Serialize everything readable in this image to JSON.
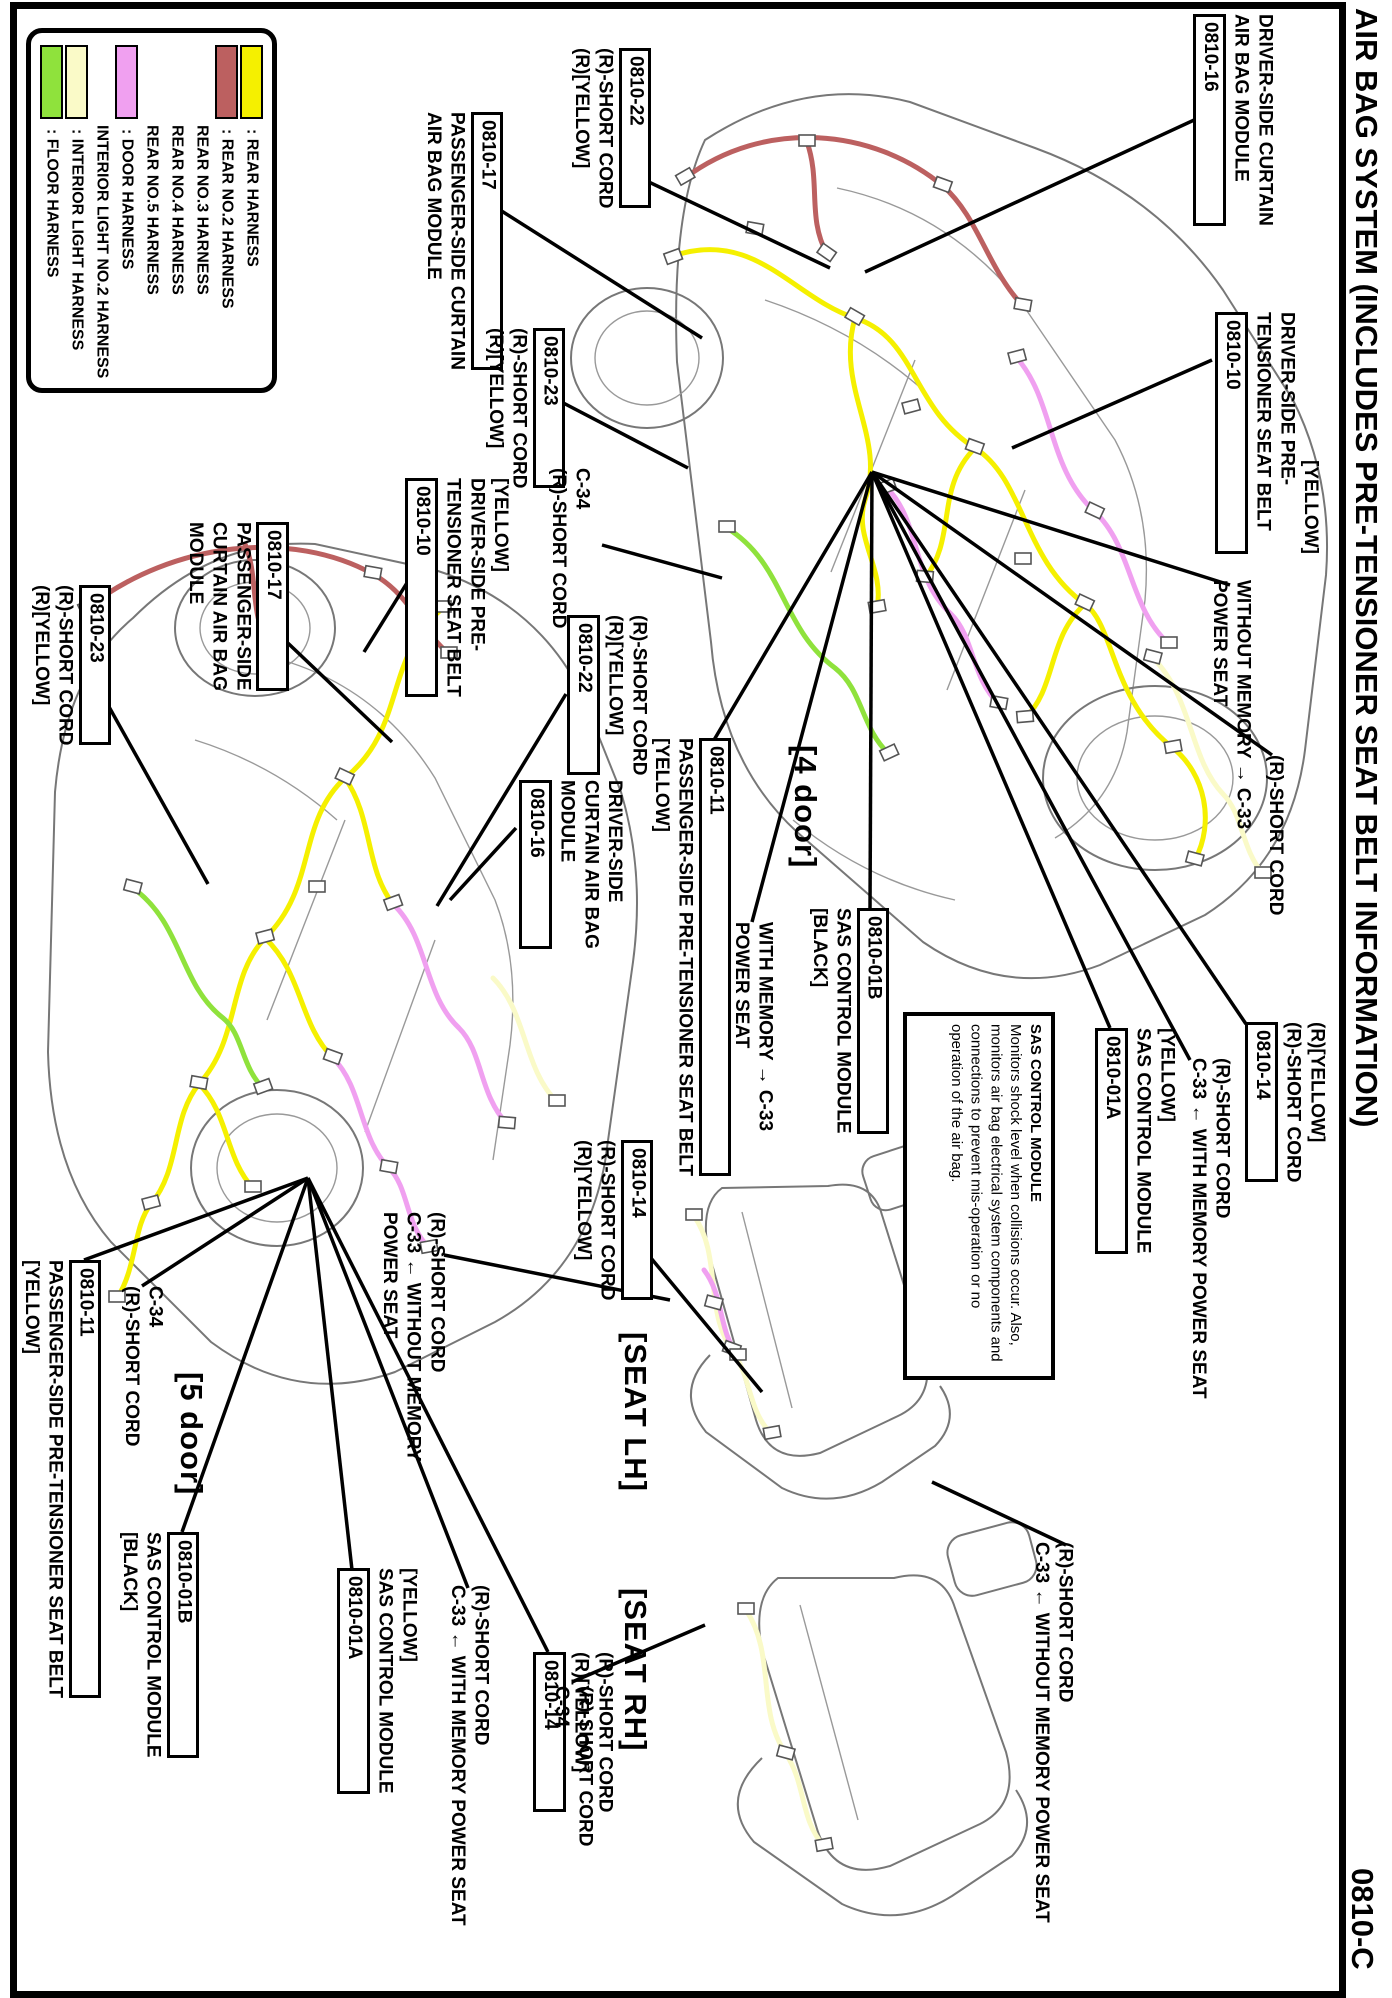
{
  "page": {
    "title": "AIR BAG SYSTEM (INCLUDES PRE-TENSIONER SEAT BELT INFORMATION)",
    "page_code": "0810-C"
  },
  "colors": {
    "floor": "#8FE23C",
    "int": "#FAFAC8",
    "door": "#F0A0F0",
    "rear2": "#BC6060",
    "rear": "#F5F000",
    "outline": "#777",
    "leader": "#000"
  },
  "legend": {
    "items": [
      {
        "label": ": FLOOR HARNESS",
        "color": "#8FE23C"
      },
      {
        "label": ": INTERIOR LIGHT HARNESS",
        "color": "#FAFAC8"
      },
      {
        "label": "INTERIOR LIGHT NO.2 HARNESS",
        "color": null
      },
      {
        "label": ": DOOR HARNESS",
        "color": "#F0A0F0"
      },
      {
        "label": "REAR NO.5 HARNESS",
        "color": null
      },
      {
        "label": "REAR NO.4 HARNESS",
        "color": null
      },
      {
        "label": "REAR NO.3 HARNESS",
        "color": null
      },
      {
        "label": ": REAR NO.2 HARNESS",
        "color": "#BC6060"
      },
      {
        "label": ": REAR HARNESS",
        "color": "#F5F000"
      }
    ]
  },
  "note": {
    "heading": "SAS CONTROL MODULE",
    "body": "Monitors shock level when collisions occur. Also, monitors air bag electrical system components and connections to prevent mis-operation or no operation of the air bag."
  },
  "callouts": [
    {
      "id": "curtain-module-driver-4door",
      "x": 1190,
      "y": 14,
      "parts": [
        {
          "t": "DRIVER-SIDE CURTAIN"
        },
        {
          "t": "AIR BAG MODULE"
        },
        {
          "t": "0810-16",
          "box": true
        }
      ]
    },
    {
      "id": "short-cord-0810-22-4door",
      "x": 568,
      "y": 48,
      "parts": [
        {
          "t": "0810-22",
          "box": true
        },
        {
          "t": "(R)-SHORT CORD"
        },
        {
          "t": "(R)[YELLOW]"
        }
      ]
    },
    {
      "id": "curtain-module-passenger-4door",
      "x": 420,
      "y": 112,
      "parts": [
        {
          "t": "0810-17",
          "box": true
        },
        {
          "t": "PASSENGER-SIDE CURTAIN"
        },
        {
          "t": "AIR BAG MODULE"
        }
      ]
    },
    {
      "id": "short-cord-0810-23-4door",
      "x": 482,
      "y": 328,
      "parts": [
        {
          "t": "0810-23",
          "box": true
        },
        {
          "t": "(R)-SHORT CORD"
        },
        {
          "t": "(R)[YELLOW]"
        }
      ]
    },
    {
      "id": "c34-4door",
      "x": 545,
      "y": 468,
      "parts": [
        {
          "t": "C-34"
        },
        {
          "t": "(R)-SHORT CORD"
        }
      ]
    },
    {
      "id": "pretensioner-driver-4door",
      "x": 1212,
      "y": 312,
      "parts": [
        {
          "t": "[YELLOW]",
          "pad": 148
        },
        {
          "t": "DRIVER-SIDE PRE-"
        },
        {
          "t": "TENSIONER SEAT BELT"
        },
        {
          "t": "0810-10",
          "box": true
        }
      ]
    },
    {
      "id": "without-memory-4door",
      "x": 1206,
      "y": 580,
      "parts": [
        {
          "t": "WITHOUT MEMORY → C-33"
        },
        {
          "t": "POWER SEAT"
        }
      ]
    },
    {
      "id": "short-cord-4door",
      "x": 1262,
      "y": 755,
      "parts": [
        {
          "t": "(R)-SHORT CORD"
        }
      ]
    },
    {
      "id": "short-cord-0810-14-4door",
      "x": 1242,
      "y": 1022,
      "parts": [
        {
          "t": "(R)[YELLOW]"
        },
        {
          "t": "(R)-SHORT CORD"
        },
        {
          "t": "0810-14",
          "box": true
        }
      ]
    },
    {
      "id": "with-memory-c33-4door",
      "x": 1185,
      "y": 1058,
      "parts": [
        {
          "t": "(R)-SHORT CORD"
        },
        {
          "t": "C-33 ← WITH MEMORY POWER SEAT"
        }
      ]
    },
    {
      "id": "sas-0810-01a-4door",
      "x": 1092,
      "y": 1028,
      "parts": [
        {
          "t": "[YELLOW]"
        },
        {
          "t": "SAS CONTROL MODULE"
        },
        {
          "t": "0810-01A",
          "box": true
        }
      ]
    },
    {
      "id": "sas-0810-01b-4door",
      "x": 806,
      "y": 908,
      "parts": [
        {
          "t": "0810-01B",
          "box": true
        },
        {
          "t": "SAS CONTROL MODULE"
        },
        {
          "t": "[BLACK]"
        }
      ]
    },
    {
      "id": "with-memory-4door",
      "x": 728,
      "y": 922,
      "parts": [
        {
          "t": "WITH MEMORY → C-33"
        },
        {
          "t": "POWER SEAT"
        }
      ]
    },
    {
      "id": "section-4door",
      "x": 786,
      "y": 745,
      "big": true,
      "parts": [
        {
          "t": "[4 door]"
        }
      ]
    },
    {
      "id": "pretensioner-passenger-4door",
      "x": 648,
      "y": 738,
      "parts": [
        {
          "t": "0810-11",
          "box": true
        },
        {
          "t": "PASSENGER-SIDE PRE-TENSIONER SEAT BELT"
        },
        {
          "t": "[YELLOW]"
        }
      ]
    },
    {
      "id": "curtain-module-driver-5door",
      "x": 516,
      "y": 780,
      "parts": [
        {
          "t": "DRIVER-SIDE"
        },
        {
          "t": "CURTAIN AIR BAG"
        },
        {
          "t": "MODULE"
        },
        {
          "t": "0810-16",
          "box": true
        }
      ]
    },
    {
      "id": "short-cord-0810-22-5door",
      "x": 564,
      "y": 615,
      "parts": [
        {
          "t": "(R)-SHORT CORD"
        },
        {
          "t": "(R)[YELLOW]"
        },
        {
          "t": "0810-22",
          "box": true
        }
      ]
    },
    {
      "id": "pretensioner-driver-5door",
      "x": 402,
      "y": 478,
      "parts": [
        {
          "t": "[YELLOW]"
        },
        {
          "t": "DRIVER-SIDE PRE-"
        },
        {
          "t": "TENSIONER SEAT BELT"
        },
        {
          "t": "0810-10",
          "box": true
        }
      ]
    },
    {
      "id": "curtain-module-passenger-5door",
      "x": 182,
      "y": 522,
      "parts": [
        {
          "t": "0810-17",
          "box": true
        },
        {
          "t": "PASSENGER-SIDE"
        },
        {
          "t": "CURTAIN AIR BAG"
        },
        {
          "t": "MODULE"
        }
      ]
    },
    {
      "id": "short-cord-0810-23-5door",
      "x": 28,
      "y": 585,
      "parts": [
        {
          "t": "0810-23",
          "box": true
        },
        {
          "t": "(R)-SHORT CORD"
        },
        {
          "t": "(R)[YELLOW]"
        }
      ]
    },
    {
      "id": "pretensioner-passenger-5door",
      "x": 18,
      "y": 1260,
      "parts": [
        {
          "t": "0810-11",
          "box": true
        },
        {
          "t": "PASSENGER-SIDE PRE-TENSIONER SEAT BELT"
        },
        {
          "t": "[YELLOW]"
        }
      ]
    },
    {
      "id": "c34-5door",
      "x": 118,
      "y": 1286,
      "parts": [
        {
          "t": "C-34"
        },
        {
          "t": "(R)-SHORT CORD"
        }
      ]
    },
    {
      "id": "section-5door",
      "x": 172,
      "y": 1372,
      "big": true,
      "parts": [
        {
          "t": "[5 door]"
        }
      ]
    },
    {
      "id": "sas-0810-01b-5door",
      "x": 116,
      "y": 1532,
      "parts": [
        {
          "t": "0810-01B",
          "box": true
        },
        {
          "t": "SAS CONTROL MODULE"
        },
        {
          "t": "[BLACK]"
        }
      ]
    },
    {
      "id": "sas-0810-01a-5door",
      "x": 334,
      "y": 1568,
      "parts": [
        {
          "t": "[YELLOW]"
        },
        {
          "t": "SAS CONTROL MODULE"
        },
        {
          "t": "0810-01A",
          "box": true
        }
      ]
    },
    {
      "id": "with-memory-c33-5door",
      "x": 444,
      "y": 1585,
      "parts": [
        {
          "t": "(R)-SHORT CORD"
        },
        {
          "t": "C-33 ← WITH MEMORY POWER SEAT"
        }
      ]
    },
    {
      "id": "short-cord-0810-14-seatlh",
      "x": 570,
      "y": 1140,
      "parts": [
        {
          "t": "0810-14",
          "box": true
        },
        {
          "t": "(R)-SHORT CORD"
        },
        {
          "t": "(R)[YELLOW]"
        }
      ]
    },
    {
      "id": "section-seat-lh",
      "x": 616,
      "y": 1332,
      "big": true,
      "parts": [
        {
          "t": "[SEAT LH]"
        }
      ]
    },
    {
      "id": "without-memory-seatlh",
      "x": 376,
      "y": 1212,
      "parts": [
        {
          "t": "(R)-SHORT CORD"
        },
        {
          "t": "C-33 ← WITHOUT MEMORY"
        },
        {
          "t": "POWER SEAT"
        }
      ]
    },
    {
      "id": "short-cord-0810-14-seatrh",
      "x": 530,
      "y": 1652,
      "parts": [
        {
          "t": "(R)-SHORT CORD"
        },
        {
          "t": "(R)[YELLOW]"
        },
        {
          "t": "0810-14",
          "box": true
        }
      ]
    },
    {
      "id": "section-seat-rh",
      "x": 616,
      "y": 1588,
      "big": true,
      "parts": [
        {
          "t": "[SEAT RH]"
        }
      ]
    },
    {
      "id": "without-memory-seatrh",
      "x": 1028,
      "y": 1542,
      "parts": [
        {
          "t": "(R)-SHORT CORD"
        },
        {
          "t": "C-33 ← WITHOUT MEMORY POWER SEAT"
        }
      ]
    },
    {
      "id": "c34-seatrh",
      "x": 548,
      "y": 1686,
      "parts": [
        {
          "t": "(R)-SHORT CORD"
        },
        {
          "t": "C-34"
        }
      ]
    }
  ],
  "leaders": [
    [
      1205,
      115,
      865,
      272
    ],
    [
      634,
      175,
      830,
      268
    ],
    [
      500,
      210,
      702,
      338
    ],
    [
      548,
      395,
      688,
      468
    ],
    [
      602,
      545,
      722,
      578
    ],
    [
      1212,
      360,
      1012,
      448
    ],
    [
      872,
      472,
      1230,
      585
    ],
    [
      872,
      472,
      1272,
      755
    ],
    [
      872,
      472,
      1246,
      1024
    ],
    [
      872,
      472,
      1190,
      1060
    ],
    [
      872,
      472,
      1110,
      1028
    ],
    [
      872,
      472,
      870,
      910
    ],
    [
      872,
      472,
      752,
      922
    ],
    [
      872,
      472,
      714,
      740
    ],
    [
      516,
      828,
      450,
      900
    ],
    [
      566,
      694,
      437,
      906
    ],
    [
      410,
      578,
      364,
      652
    ],
    [
      272,
      628,
      392,
      742
    ],
    [
      94,
      680,
      208,
      884
    ],
    [
      636,
      1240,
      762,
      1392
    ],
    [
      444,
      1255,
      670,
      1300
    ],
    [
      308,
      1178,
      548,
      1652
    ],
    [
      308,
      1178,
      468,
      1588
    ],
    [
      308,
      1178,
      352,
      1570
    ],
    [
      308,
      1178,
      182,
      1532
    ],
    [
      308,
      1178,
      142,
      1286
    ],
    [
      308,
      1178,
      84,
      1260
    ],
    [
      1066,
      1545,
      932,
      1482
    ],
    [
      572,
      1682,
      705,
      1625
    ]
  ]
}
